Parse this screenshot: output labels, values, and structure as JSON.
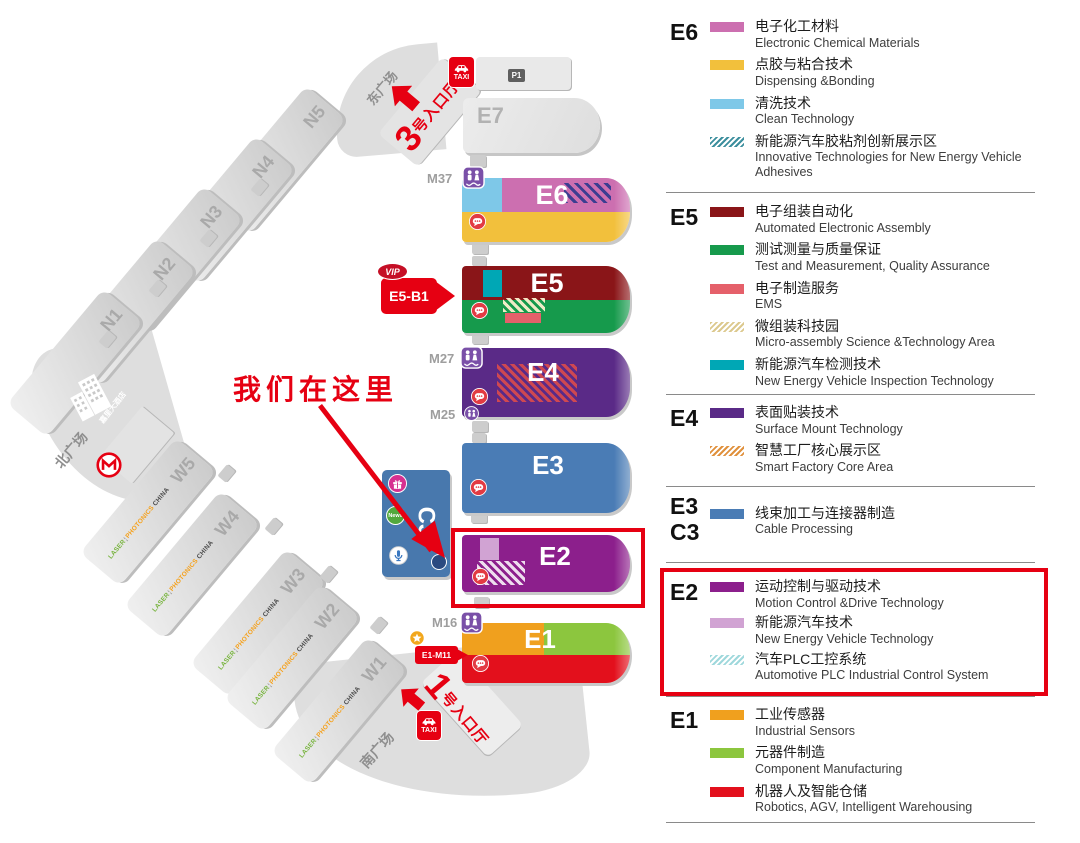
{
  "map": {
    "we_are_here": "我们在这里",
    "plazas": {
      "east": "东广场",
      "north": "北广场",
      "south": "南广场"
    },
    "hotel_label": "嘉里大酒店",
    "taxi_label": "TAXI",
    "parking_label": "P1",
    "entrance3": {
      "number": "3",
      "suffix": "号入口厅"
    },
    "entrance1": {
      "number": "1",
      "suffix": "号入口厅"
    },
    "vip_badge": "VIP",
    "vip_gate_label": "E5-B1",
    "e1_gate_label": "E1-M11",
    "meeting_points": {
      "m37": "M37",
      "m27": "M27",
      "m25": "M25",
      "m16": "M16"
    },
    "news_badge": "News",
    "branding": {
      "laser": "LASER",
      "photonics": "PHOTONICS",
      "china": "CHINA"
    },
    "gray_halls": {
      "n1": "N1",
      "n2": "N2",
      "n3": "N3",
      "n4": "N4",
      "n5": "N5",
      "w1": "W1",
      "w2": "W2",
      "w3": "W3",
      "w4": "W4",
      "w5": "W5",
      "e7": "E7"
    },
    "color_halls": {
      "e1": "E1",
      "e2": "E2",
      "e3": "E3",
      "e4": "E4",
      "e5": "E5",
      "e6": "E6",
      "c3": "C3"
    }
  },
  "legend": {
    "sections": [
      {
        "code": "E6",
        "items": [
          {
            "zh": "电子化工材料",
            "en": "Electronic Chemical Materials"
          },
          {
            "zh": "点胶与粘合技术",
            "en": "Dispensing &Bonding"
          },
          {
            "zh": "清洗技术",
            "en": "Clean Technology"
          },
          {
            "zh": "新能源汽车胶粘剂创新展示区",
            "en": "Innovative Technologies for New Energy Vehicle Adhesives"
          }
        ]
      },
      {
        "code": "E5",
        "items": [
          {
            "zh": "电子组装自动化",
            "en": "Automated Electronic Assembly"
          },
          {
            "zh": "测试测量与质量保证",
            "en": "Test and Measurement, Quality Assurance"
          },
          {
            "zh": "电子制造服务",
            "en": "EMS"
          },
          {
            "zh": "微组装科技园",
            "en": "Micro-assembly Science &Technology Area"
          },
          {
            "zh": "新能源汽车检测技术",
            "en": "New Energy Vehicle Inspection Technology"
          }
        ]
      },
      {
        "code": "E4",
        "items": [
          {
            "zh": "表面贴装技术",
            "en": "Surface Mount Technology"
          },
          {
            "zh": "智慧工厂核心展示区",
            "en": "Smart Factory Core Area"
          }
        ]
      },
      {
        "code": "E3",
        "code2": "C3",
        "items": [
          {
            "zh": "线束加工与连接器制造",
            "en": "Cable Processing"
          }
        ]
      },
      {
        "code": "E2",
        "highlighted": true,
        "items": [
          {
            "zh": "运动控制与驱动技术",
            "en": "Motion Control &Drive Technology"
          },
          {
            "zh": "新能源汽车技术",
            "en": "New Energy Vehicle Technology"
          },
          {
            "zh": "汽车PLC工控系统",
            "en": "Automotive PLC Industrial Control System"
          }
        ]
      },
      {
        "code": "E1",
        "items": [
          {
            "zh": "工业传感器",
            "en": "Industrial Sensors"
          },
          {
            "zh": "元器件制造",
            "en": "Component Manufacturing"
          },
          {
            "zh": "机器人及智能仓储",
            "en": "Robotics, AGV, Intelligent Warehousing"
          }
        ]
      }
    ]
  },
  "colors": {
    "accent_red": "#e60012",
    "e6_pink": "#cc6fb0",
    "e6_yellow": "#f2c03c",
    "e6_blue": "#7ec8e8",
    "e6_hatch_teal": "#3d8f9e",
    "e5_darkred": "#8a1518",
    "e5_green": "#169a4c",
    "e5_ems": "#e5606a",
    "e5_hatch_beige": "#dcc98e",
    "e5_teal": "#00a7b5",
    "e4_purple": "#5a2a87",
    "e4_hatch_orange": "#e0913d",
    "e3_blue": "#4a7cb5",
    "e2_purple": "#8c1f8c",
    "e2_lilac": "#d1a3d3",
    "e2_hatch_cyan": "#9fd8dc",
    "e1_orange": "#f0a01e",
    "e1_green": "#8cc63e",
    "e1_red": "#e3101c",
    "hall_gray": "#d9d9d9",
    "marker_purple": "#7a50a8"
  }
}
